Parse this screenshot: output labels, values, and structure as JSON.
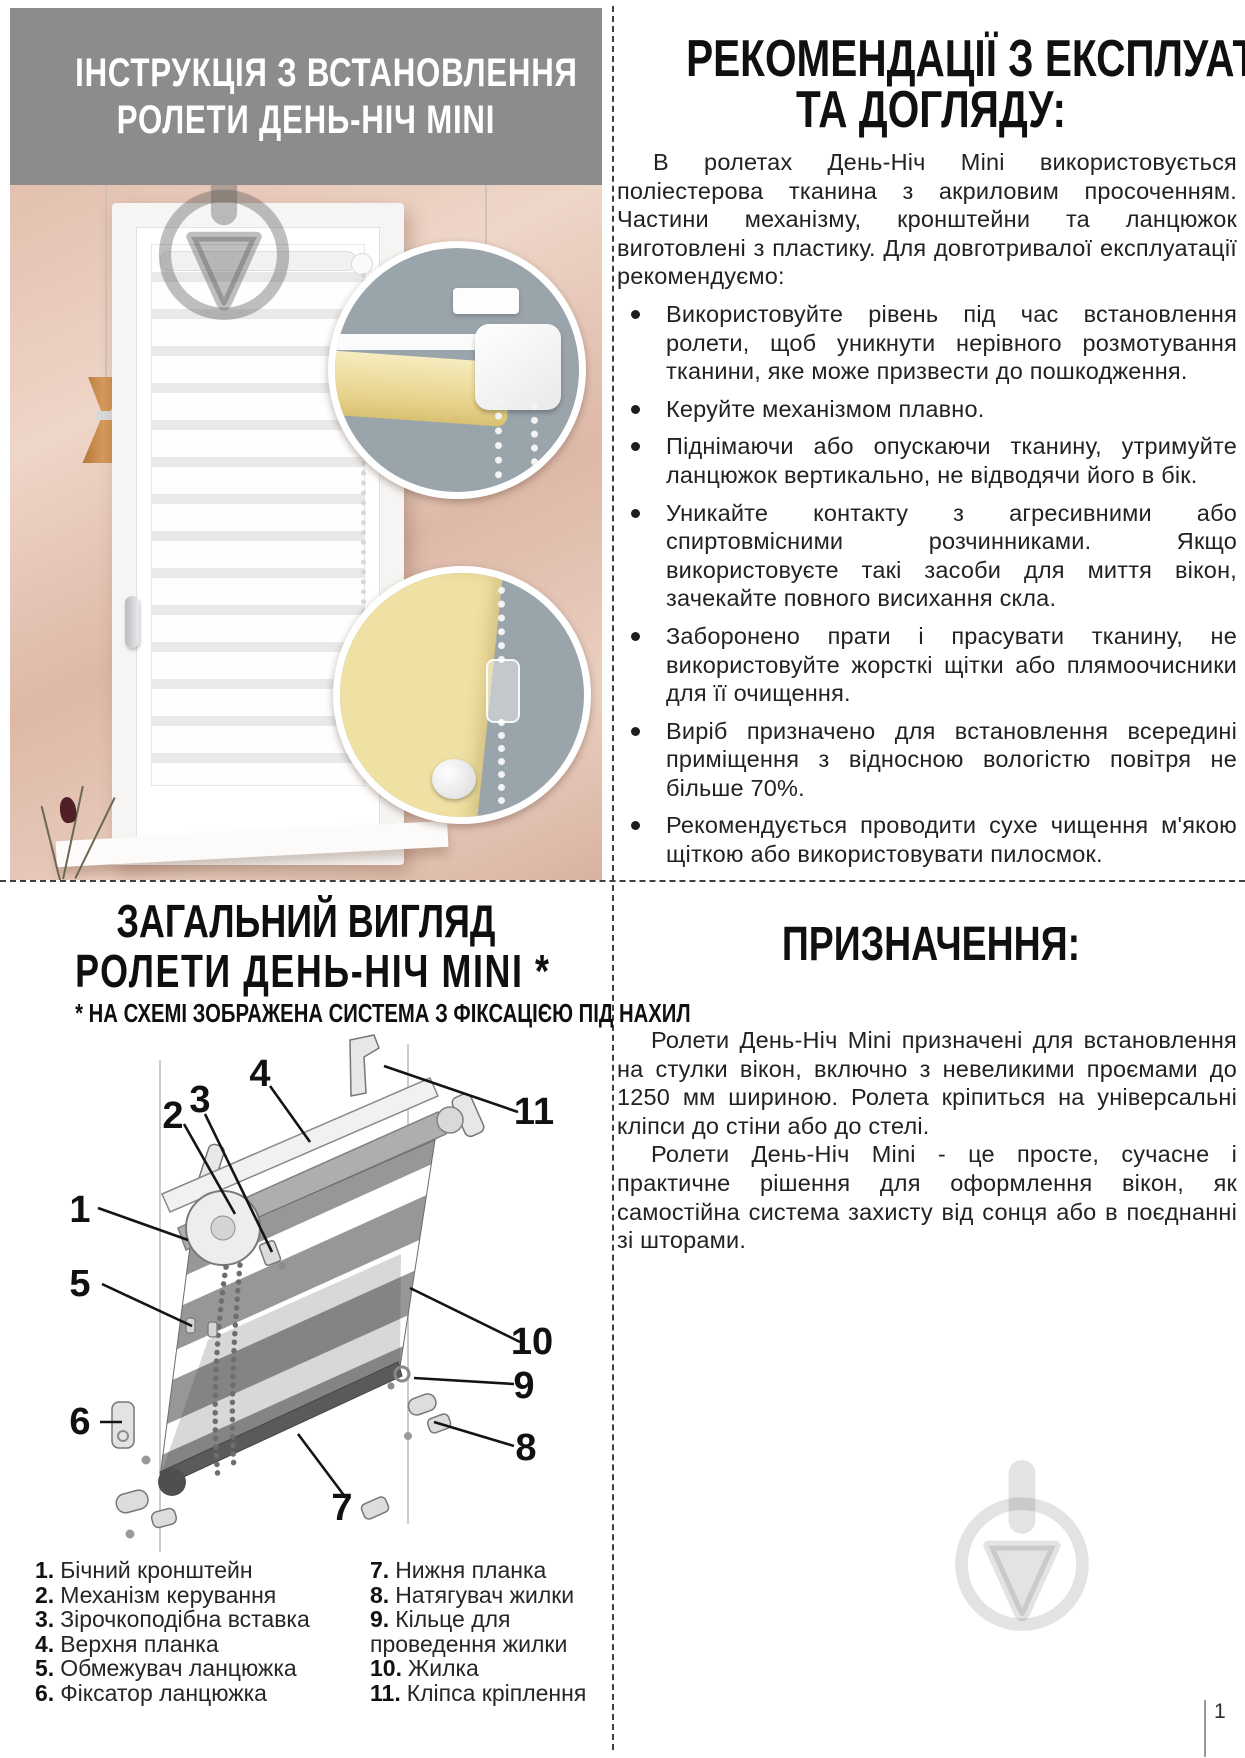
{
  "page": {
    "number": "1"
  },
  "colors": {
    "header_gray": "#8c8c8c",
    "text_black": "#1e1e1e",
    "callout_bg": "#9aa4ab",
    "fabric_yellow": "#efe0a3",
    "copper": "#c08448",
    "wall_pink": "#e3c0af"
  },
  "top_left": {
    "header": {
      "line1": "ІНСТРУКЦІЯ  З  ВСТАНОВЛЕННЯ",
      "line2": "РОЛЕТИ  ДЕНЬ-НІЧ  MINI"
    },
    "photo_icons": [
      "window-blind-photo",
      "mechanism-callout",
      "chain-fixator-callout"
    ]
  },
  "top_right": {
    "title_line1": "РЕКОМЕНДАЦІЇ З ЕКСПЛУАТАЦІЇ",
    "title_line2": "ТА ДОГЛЯДУ:",
    "intro": "В ролетах День-Ніч Mini використовується поліестерова тканина з акриловим просоченням. Частини механізму, кронштейни та ланцюжок виготовлені з пластику. Для довготривалої експлуатації рекомендуємо:",
    "bullets": [
      "Використовуйте рівень під час встановлення ролети, щоб уникнути нерівного розмотування тканини, яке може призвести до пошкодження.",
      "Керуйте механізмом плавно.",
      "Піднімаючи або опускаючи тканину, утримуйте ланцюжок вертикально, не відводячи його в бік.",
      "Уникайте контакту з агресивними або спиртовмісними розчинниками. Якщо використовуєте такі засоби для миття вікон, зачекайте повного висихання скла.",
      "Заборонено прати і прасувати тканину, не використовуйте жорсткі щітки або плямоочисники для її очищення.",
      "Виріб призначено для встановлення всередині приміщення з відносною вологістю повітря не більше 70%.",
      "Рекомендується проводити сухе чищення м'якою щіткою або використовувати пилосмок."
    ]
  },
  "bottom_left": {
    "title_line1": "ЗАГАЛЬНИЙ ВИГЛЯД",
    "title_line2": "РОЛЕТИ  ДЕНЬ-НІЧ  MINI *",
    "subtitle": "* НА СХЕМІ ЗОБРАЖЕНА СИСТЕМА З ФІКСАЦІЄЮ ПІД НАХИЛ",
    "diagram": {
      "labels": [
        "1",
        "2",
        "3",
        "4",
        "5",
        "6",
        "7",
        "8",
        "9",
        "10",
        "11"
      ]
    },
    "legend_left": [
      {
        "num": "1.",
        "text": "Бічний кронштейн"
      },
      {
        "num": "2.",
        "text": "Механізм керування"
      },
      {
        "num": "3.",
        "text": "Зірочкоподібна вставка"
      },
      {
        "num": "4.",
        "text": "Верхня планка"
      },
      {
        "num": "5.",
        "text": "Обмежувач ланцюжка"
      },
      {
        "num": "6.",
        "text": "Фіксатор ланцюжка"
      }
    ],
    "legend_right": [
      {
        "num": "7.",
        "text": "Нижня планка"
      },
      {
        "num": "8.",
        "text": "Натягувач жилки"
      },
      {
        "num": "9.",
        "text": "Кільце для проведення жилки"
      },
      {
        "num": "10.",
        "text": "Жилка"
      },
      {
        "num": "11.",
        "text": "Кліпса кріплення"
      }
    ]
  },
  "bottom_right": {
    "title": "ПРИЗНАЧЕННЯ:",
    "para1": "Ролети День-Ніч Mini призначені для встановлення на стулки вікон, включно з невеликими проємами до 1250 мм шириною. Ролета кріпиться на універсальні кліпси до стіни або до стелі.",
    "para2": "Ролети День-Ніч Mini - це просте, сучасне і практичне рішення для оформлення вікон, як самостійна система захисту від сонця або в поєднанні зі шторами."
  }
}
